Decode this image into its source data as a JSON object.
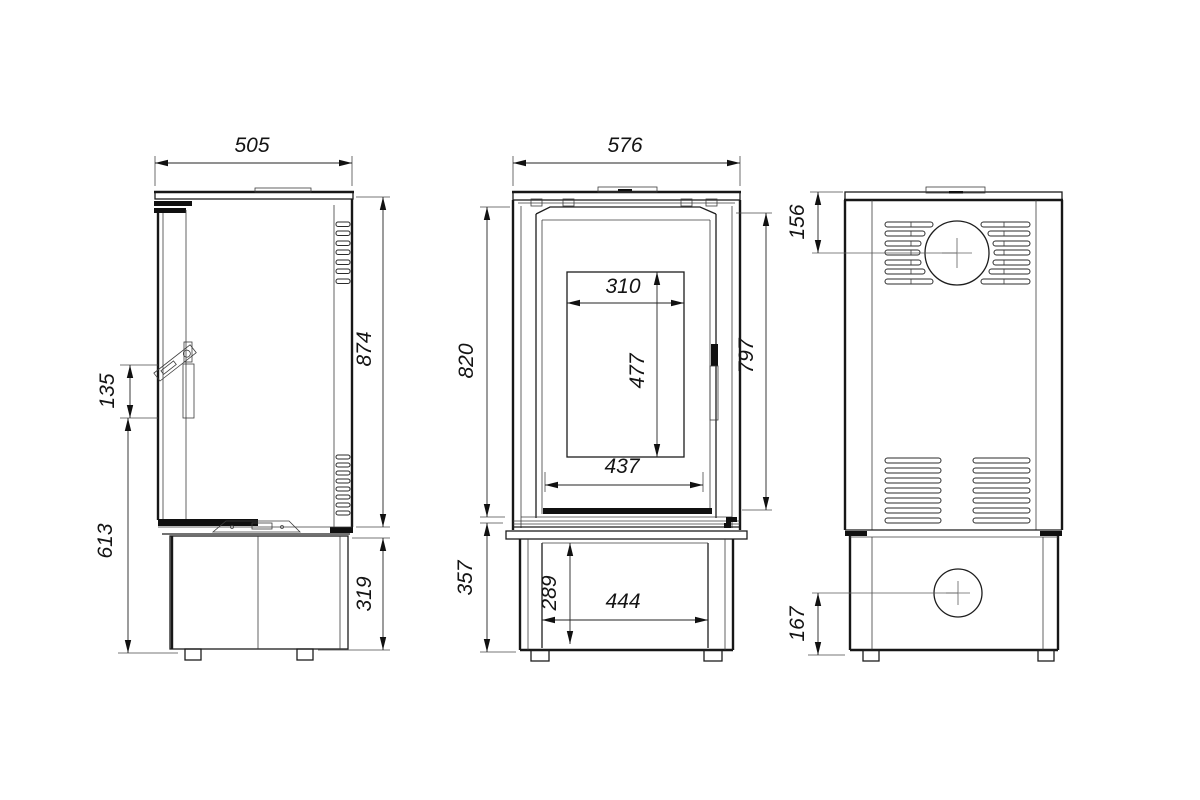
{
  "drawing": {
    "background": "#ffffff",
    "line_color": "#171717",
    "views": {
      "side": {
        "name": "side view",
        "dims": {
          "width": "505",
          "body_height": "874",
          "handle_length": "135",
          "handle_height_from_floor": "613",
          "base_height": "319"
        }
      },
      "front": {
        "name": "front view",
        "dims": {
          "width": "576",
          "body_height": "820",
          "glass_width": "310",
          "glass_height": "477",
          "door_height": "797",
          "door_opening_width": "437",
          "base_height": "357",
          "base_opening_height": "289",
          "base_opening_width": "444"
        }
      },
      "rear": {
        "name": "rear view",
        "dims": {
          "flue_centre_from_top": "156",
          "inlet_centre_from_floor": "167"
        }
      }
    }
  }
}
